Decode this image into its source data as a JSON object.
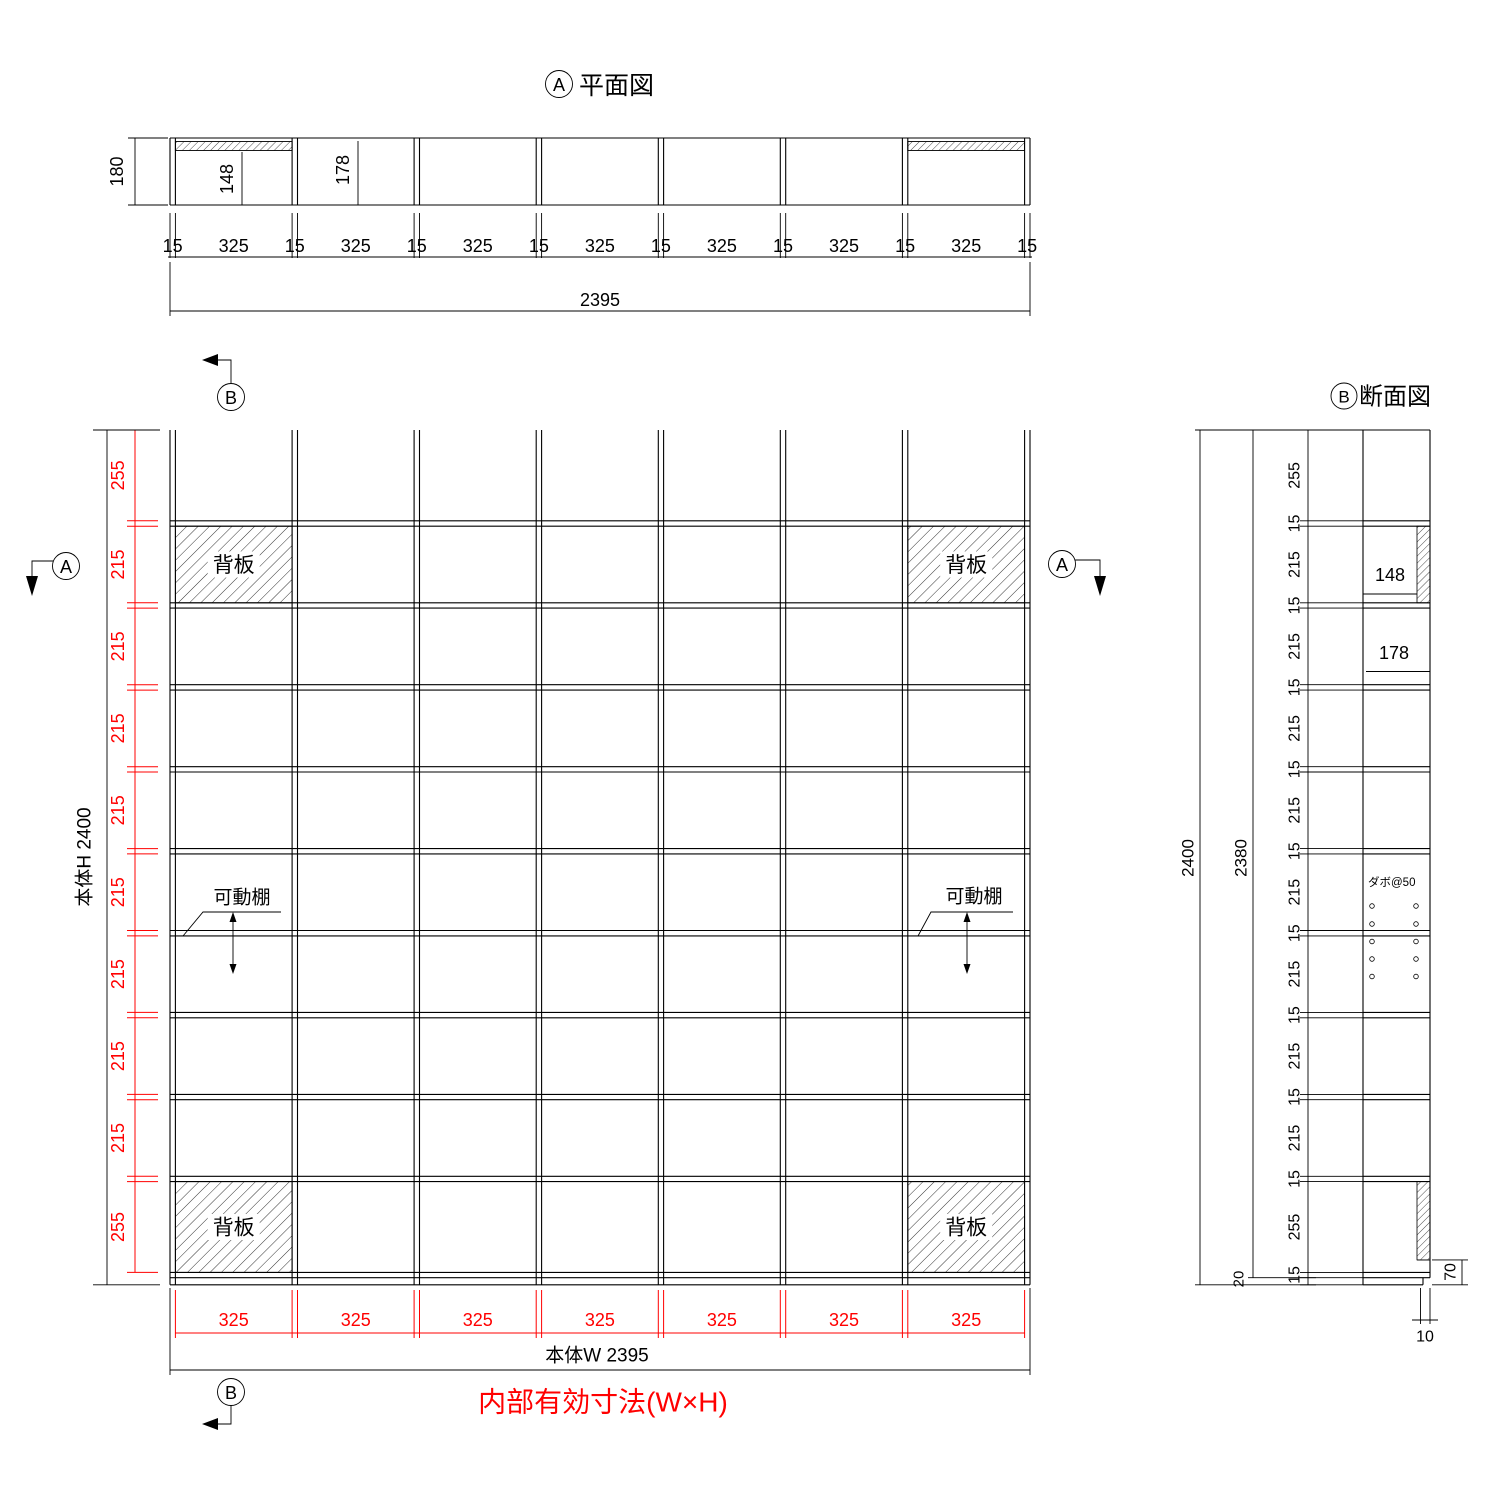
{
  "colors": {
    "line": "#000000",
    "dim_red": "#ff0000",
    "background": "#ffffff"
  },
  "plan": {
    "marker": "A",
    "title": "平面図",
    "depth": "180",
    "cell_back_depth": "148",
    "cell_open_depth": "178",
    "chain": [
      "15",
      "325",
      "15",
      "325",
      "15",
      "325",
      "15",
      "325",
      "15",
      "325",
      "15",
      "325",
      "15",
      "325",
      "15"
    ],
    "overall": "2395"
  },
  "elevation": {
    "marker_top": "B",
    "marker_bottom": "B",
    "marker_left": "A",
    "marker_right": "A",
    "height_label": "本体H 2400",
    "width_label": "本体W 2395",
    "rows": [
      "255",
      "215",
      "215",
      "215",
      "215",
      "215",
      "215",
      "215",
      "215",
      "255"
    ],
    "cols": [
      "325",
      "325",
      "325",
      "325",
      "325",
      "325",
      "325"
    ],
    "back_panels": [
      "背板",
      "背板",
      "背板",
      "背板"
    ],
    "movable_shelves": [
      "可動棚",
      "可動棚"
    ],
    "note": "内部有効寸法(W×H)"
  },
  "section": {
    "marker": "B",
    "title": "断面図",
    "overall": "2400",
    "inner": "2380",
    "base_gap": "20",
    "chain": [
      "255",
      "15",
      "215",
      "15",
      "215",
      "15",
      "215",
      "15",
      "215",
      "15",
      "215",
      "15",
      "215",
      "15",
      "215",
      "15",
      "215",
      "15",
      "255",
      "15"
    ],
    "cell_back_depth": "148",
    "cell_open_depth": "178",
    "dowel_note": "ダボ@50",
    "base_height": "70",
    "base_setback": "10"
  }
}
